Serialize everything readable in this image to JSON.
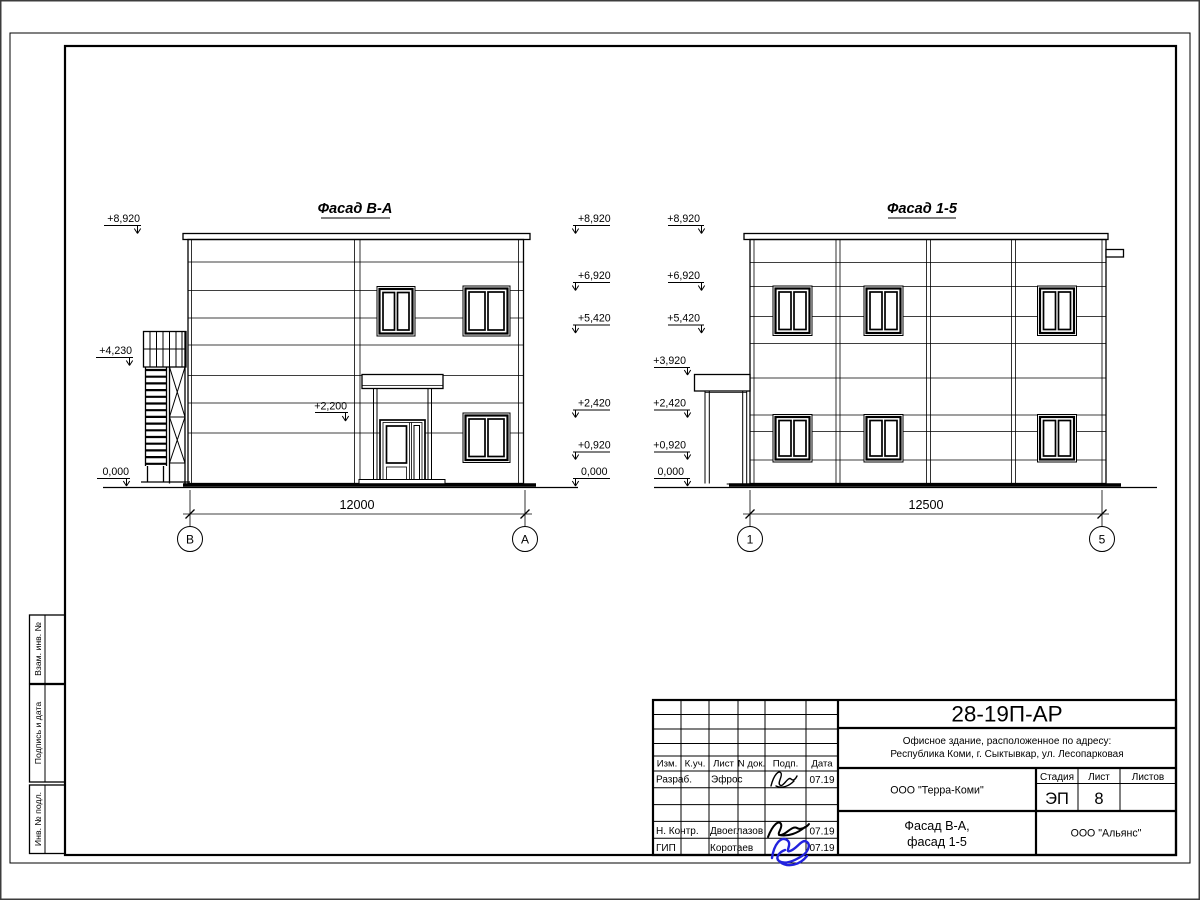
{
  "colors": {
    "paper": "#ffffff",
    "line": "#000000",
    "signature_blue": "#2222dd"
  },
  "facade_ba": {
    "title": "Фасад В-А",
    "dim": "12000",
    "axis_left": "В",
    "axis_right": "А",
    "marks_left": [
      "+8,920",
      "+4,230",
      "0,000"
    ],
    "marks_right": [
      "+8,920",
      "+6,920",
      "+5,420",
      "+2,420",
      "+0,920",
      "0,000"
    ],
    "mark_inner": "+2,200"
  },
  "facade_15": {
    "title": "Фасад 1-5",
    "dim": "12500",
    "axis_left": "1",
    "axis_right": "5",
    "marks_left": [
      "+8,920",
      "+6,920",
      "+5,420",
      "+3,920",
      "+2,420",
      "+0,920",
      "0,000"
    ]
  },
  "title_block": {
    "doc_number": "28-19П-АР",
    "address_line1": "Офисное здание, расположенное по адресу:",
    "address_line2": "Республика Коми, г. Сыктывкар, ул. Лесопарковая",
    "client": "ООО \"Терра-Коми\"",
    "stage_label": "Стадия",
    "sheet_label": "Лист",
    "sheets_label": "Листов",
    "stage": "ЭП",
    "sheet_no": "8",
    "sheets_total": "",
    "title_line1": "Фасад В-А,",
    "title_line2": "фасад 1-5",
    "contractor": "ООО \"Альянс\"",
    "header_cols": [
      "Изм.",
      "К.уч.",
      "Лист",
      "N док.",
      "Подп.",
      "Дата"
    ],
    "developer_role": "Разраб.",
    "developer_name": "Эфрос",
    "developer_date": "07.19",
    "ncontrol_role": "Н. Контр.",
    "ncontrol_name": "Двоеглазов",
    "ncontrol_date": "07.19",
    "gip_role": "ГИП",
    "gip_name": "Коротаев",
    "gip_date": "07.19"
  },
  "side_stamps": {
    "labels": [
      "Взам. инв. №",
      "Подпись и дата",
      "Инв. № подл."
    ]
  }
}
